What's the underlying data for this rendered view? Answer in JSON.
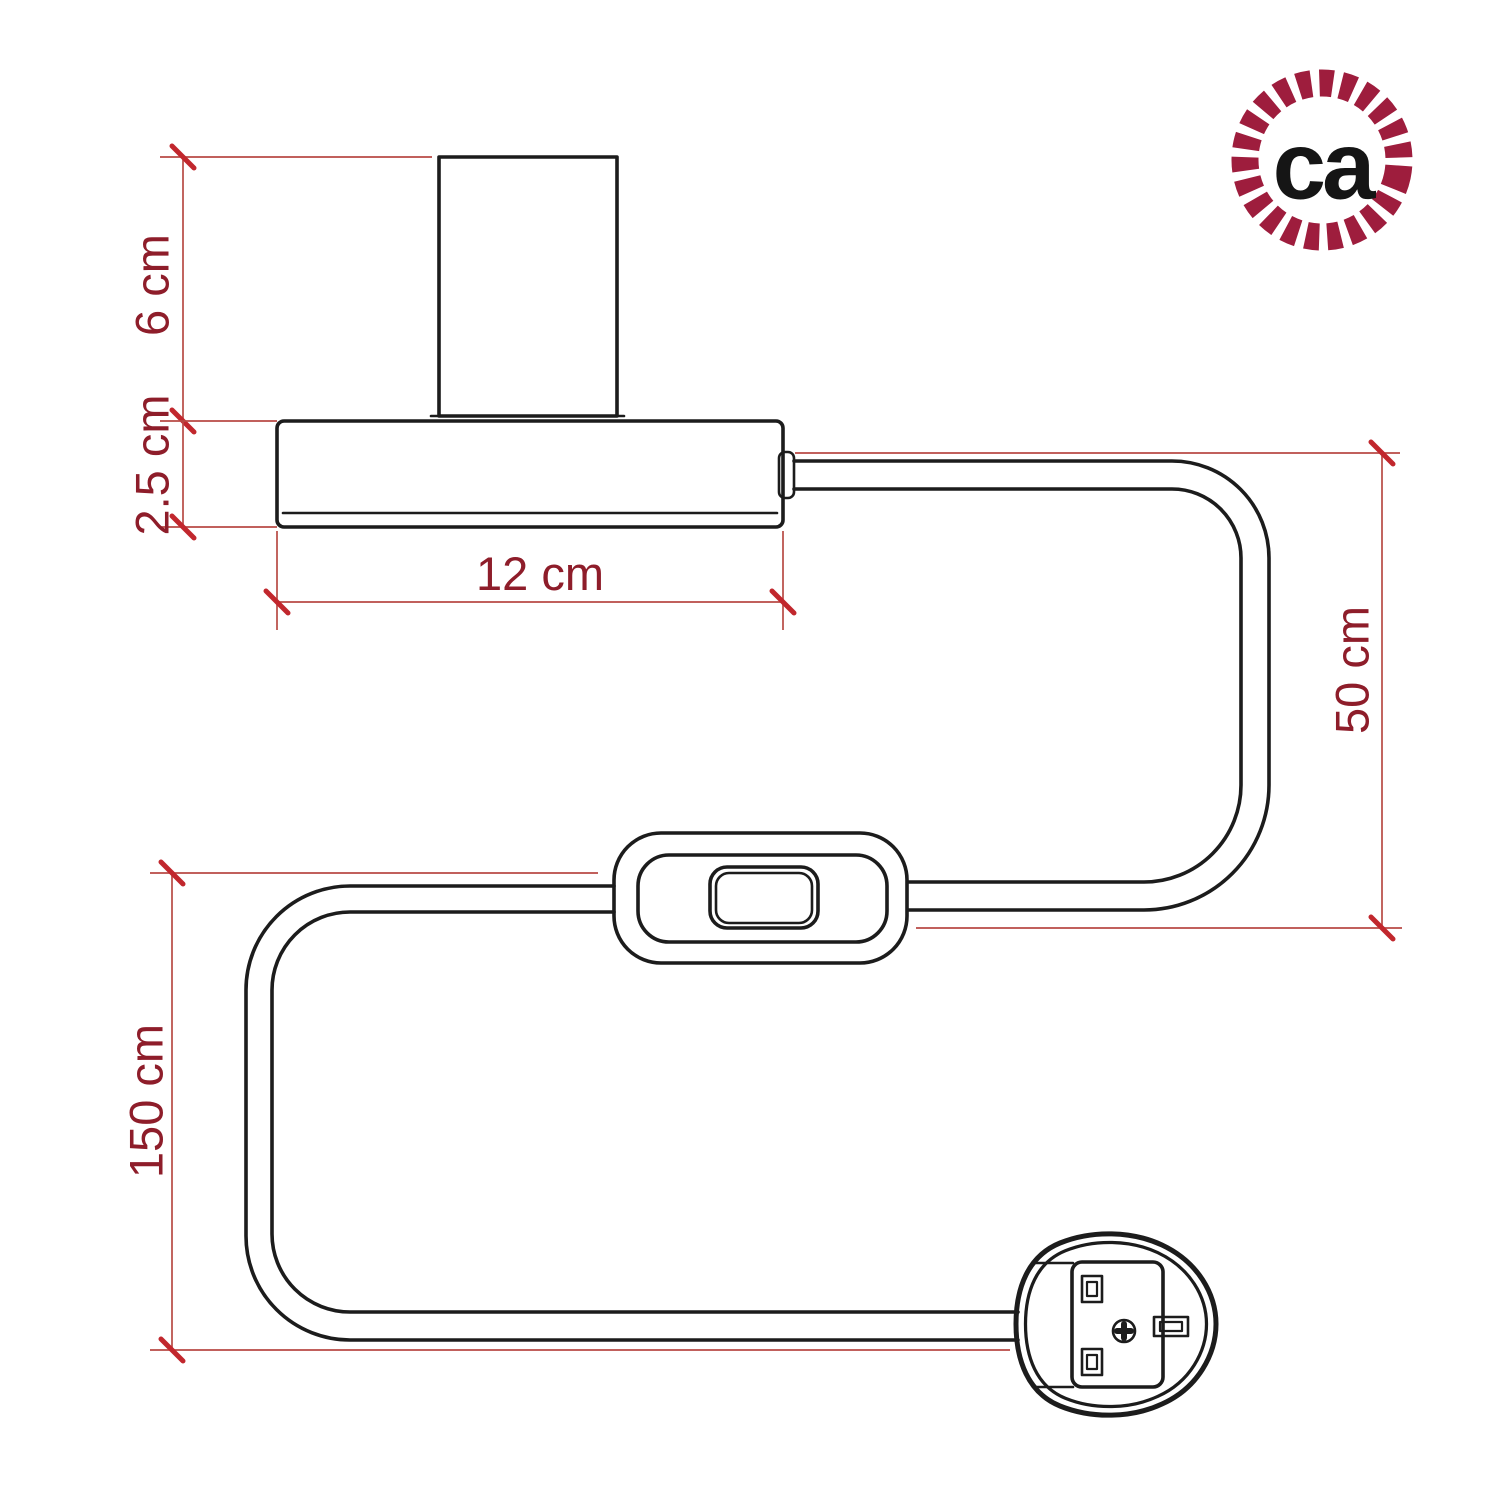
{
  "logo": {
    "text": "ca"
  },
  "dimensions": {
    "socket_height": {
      "label": "6 cm"
    },
    "base_height": {
      "label": "2.5 cm"
    },
    "base_width": {
      "label": "12 cm"
    },
    "switch_distance": {
      "label": "50 cm"
    },
    "total_length": {
      "label": "150 cm"
    }
  },
  "colors": {
    "outline": "#1c1c1c",
    "dim_line": "#b84a44",
    "tick": "#c1272d",
    "label": "#8e1d2a",
    "logo_ring": "#9e1d3d",
    "logo_text": "#151515",
    "background": "#ffffff"
  }
}
